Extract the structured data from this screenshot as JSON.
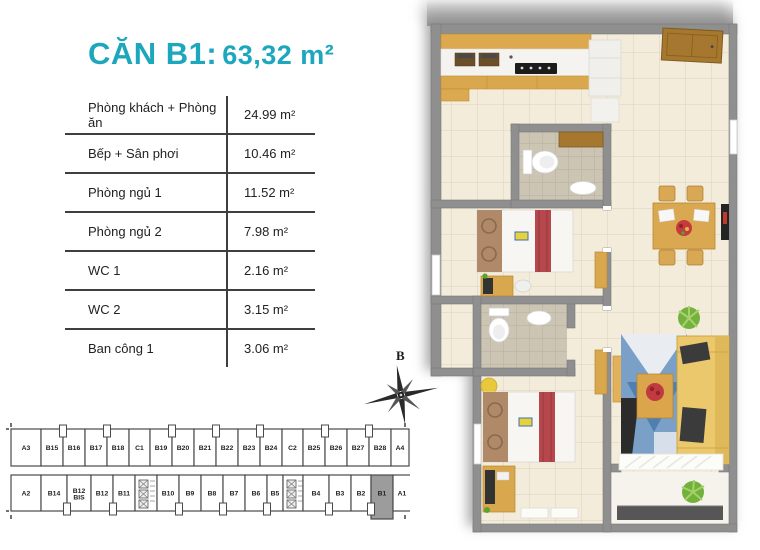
{
  "title": {
    "unit": "CĂN B1:",
    "area": "63,32 m²"
  },
  "areas_table": {
    "rows": [
      {
        "label": "Phòng khách + Phòng ăn",
        "value": "24.99 m²"
      },
      {
        "label": "Bếp + Sân phơi",
        "value": "10.46 m²"
      },
      {
        "label": "Phòng ngủ 1",
        "value": "11.52 m²"
      },
      {
        "label": "Phòng ngủ 2",
        "value": "7.98 m²"
      },
      {
        "label": "WC 1",
        "value": "2.16 m²"
      },
      {
        "label": "WC 2",
        "value": "3.15 m²"
      },
      {
        "label": "Ban công 1",
        "value": "3.06 m²"
      }
    ]
  },
  "compass": {
    "north_label": "B"
  },
  "floor_strip": {
    "highlight_unit": "B1",
    "top_row": [
      {
        "label": "A3",
        "w": 30
      },
      {
        "label": "B15",
        "w": 22
      },
      {
        "label": "B16",
        "w": 22
      },
      {
        "label": "B17",
        "w": 22
      },
      {
        "label": "B18",
        "w": 22
      },
      {
        "label": "C1",
        "w": 21
      },
      {
        "label": "B19",
        "w": 22
      },
      {
        "label": "B20",
        "w": 22
      },
      {
        "label": "B21",
        "w": 22
      },
      {
        "label": "B22",
        "w": 22
      },
      {
        "label": "B23",
        "w": 22
      },
      {
        "label": "B24",
        "w": 22
      },
      {
        "label": "C2",
        "w": 21
      },
      {
        "label": "B25",
        "w": 22
      },
      {
        "label": "B26",
        "w": 22
      },
      {
        "label": "B27",
        "w": 22
      },
      {
        "label": "B28",
        "w": 22
      },
      {
        "label": "A4",
        "w": 18
      }
    ],
    "bottom_row": [
      {
        "label": "A2",
        "w": 30
      },
      {
        "label": "B14",
        "w": 26
      },
      {
        "label": "B12 BIS",
        "w": 24
      },
      {
        "label": "B12",
        "w": 22
      },
      {
        "label": "B11",
        "w": 22
      },
      {
        "type": "core",
        "w": 22
      },
      {
        "label": "B10",
        "w": 22
      },
      {
        "label": "B9",
        "w": 22
      },
      {
        "label": "B8",
        "w": 22
      },
      {
        "label": "B7",
        "w": 22
      },
      {
        "label": "B6",
        "w": 22
      },
      {
        "label": "B5",
        "w": 16
      },
      {
        "type": "core",
        "w": 20
      },
      {
        "label": "B4",
        "w": 26
      },
      {
        "label": "B3",
        "w": 22
      },
      {
        "label": "B2",
        "w": 20
      },
      {
        "label": "B1",
        "w": 22
      },
      {
        "label": "A1",
        "w": 18
      }
    ],
    "top_notches_after": [
      1,
      3,
      6,
      8,
      10,
      13,
      15
    ],
    "bottom_notches_after": [
      1,
      3,
      6,
      8,
      10,
      13,
      15
    ]
  },
  "colors": {
    "accent": "#1ca7bd",
    "wall": "#8f8f8f",
    "highlight_fill": "#9c9c9c",
    "floor": "#f3ecda",
    "wood": "#d9a84e",
    "sofa": "#eac86b",
    "rug_blue": "#7aa0c8",
    "accent_red": "#b5474d"
  }
}
